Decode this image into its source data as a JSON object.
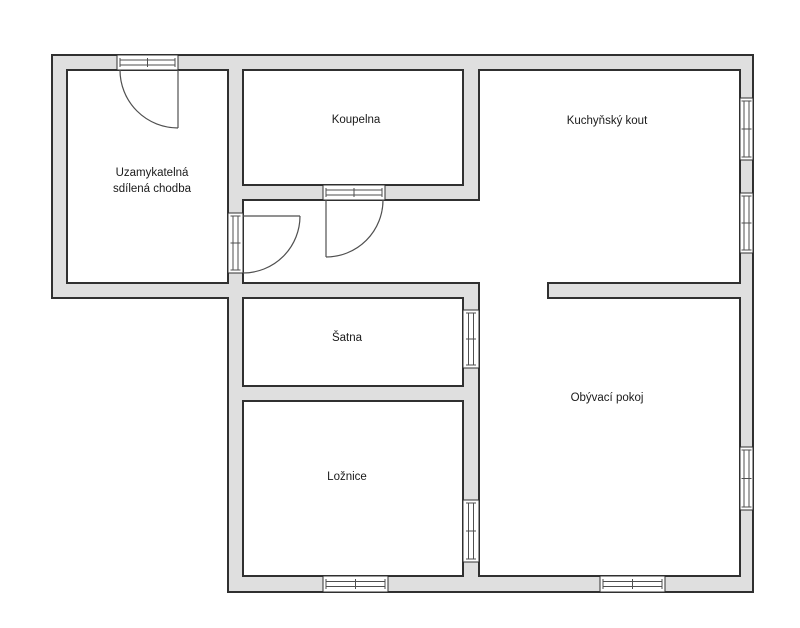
{
  "diagram": {
    "type": "floor-plan",
    "rooms": [
      {
        "id": "hallway",
        "label_line1": "Uzamykatelná",
        "label_line2": "sdílená chodba"
      },
      {
        "id": "bathroom",
        "label": "Koupelna"
      },
      {
        "id": "kitchen",
        "label": "Kuchyňský kout"
      },
      {
        "id": "closet",
        "label": "Šatna"
      },
      {
        "id": "bedroom",
        "label": "Ložnice"
      },
      {
        "id": "living_room",
        "label": "Obývací pokoj"
      }
    ]
  },
  "colors": {
    "background": "#ffffff",
    "wall_fill": "#dfdfdf",
    "wall_line": "#303030",
    "detail_line": "#4f4f4f",
    "text": "#1a1a1a"
  }
}
